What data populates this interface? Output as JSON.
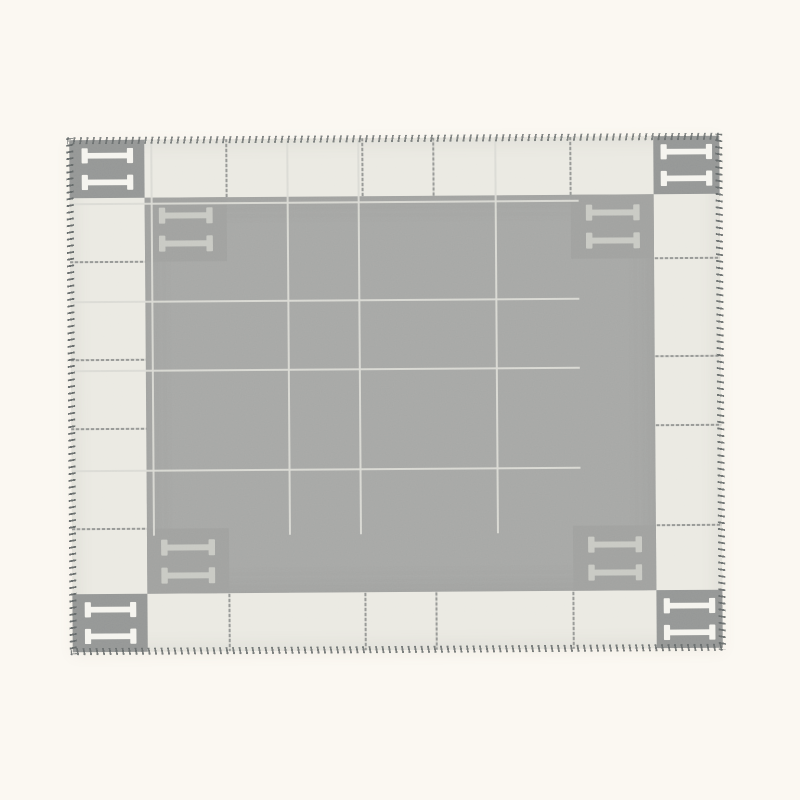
{
  "meta": {
    "type": "product-photograph",
    "subject": "grey and ecru wool throw blanket, flat lay",
    "pattern": "windowpane check with H motifs in corner blocks",
    "background_style": "plain warm-white studio background"
  },
  "colors": {
    "background": "#fbf8f2",
    "border_cream": "#eae9e2",
    "field_grey": "#a6a7a5",
    "inner_cell_grey": "#a0a19f",
    "corner_grey": "#949695",
    "motif_white": "#f5f4ee",
    "motif_light_grey": "#c8c9c3",
    "grid_line_light": "#dadad4",
    "grid_line_dark": "#8d8f8d",
    "stitch": "#666b6b"
  },
  "blanket": {
    "frame": {
      "left": 71,
      "top": 138,
      "width": 650,
      "height": 512,
      "rotation_deg": -0.4
    },
    "border_band": {
      "left": 75,
      "top": 58,
      "right": 66,
      "bottom": 58
    },
    "grid": {
      "vertical_x": [
        157,
        293,
        364,
        501
      ],
      "horizontal_y": [
        122,
        220,
        289,
        389
      ]
    },
    "blocks": [
      {
        "name": "corner-block-top-left",
        "x": 0,
        "y": 0,
        "w": 75,
        "h": 58,
        "fill": "corner_grey",
        "motif_color": "motif_white",
        "motif_w": 52,
        "motif_h": 42
      },
      {
        "name": "corner-block-top-right",
        "x": 584,
        "y": 0,
        "w": 66,
        "h": 58,
        "fill": "corner_grey",
        "motif_color": "motif_white",
        "motif_w": 52,
        "motif_h": 42
      },
      {
        "name": "corner-block-bottom-left",
        "x": 0,
        "y": 454,
        "w": 75,
        "h": 58,
        "fill": "corner_grey",
        "motif_color": "motif_white",
        "motif_w": 52,
        "motif_h": 42
      },
      {
        "name": "corner-block-bottom-right",
        "x": 584,
        "y": 454,
        "w": 66,
        "h": 58,
        "fill": "corner_grey",
        "motif_color": "motif_white",
        "motif_w": 52,
        "motif_h": 42
      },
      {
        "name": "inner-block-top-left",
        "x": 75,
        "y": 58,
        "w": 82,
        "h": 64,
        "fill": "inner_cell_grey",
        "motif_color": "motif_light_grey",
        "motif_w": 54,
        "motif_h": 46
      },
      {
        "name": "inner-block-top-right",
        "x": 501,
        "y": 58,
        "w": 83,
        "h": 64,
        "fill": "inner_cell_grey",
        "motif_color": "motif_light_grey",
        "motif_w": 54,
        "motif_h": 46
      },
      {
        "name": "inner-block-bottom-left",
        "x": 75,
        "y": 389,
        "w": 82,
        "h": 65,
        "fill": "inner_cell_grey",
        "motif_color": "motif_light_grey",
        "motif_w": 54,
        "motif_h": 46
      },
      {
        "name": "inner-block-bottom-right",
        "x": 501,
        "y": 389,
        "w": 83,
        "h": 65,
        "fill": "inner_cell_grey",
        "motif_color": "motif_light_grey",
        "motif_w": 54,
        "motif_h": 46
      }
    ]
  }
}
